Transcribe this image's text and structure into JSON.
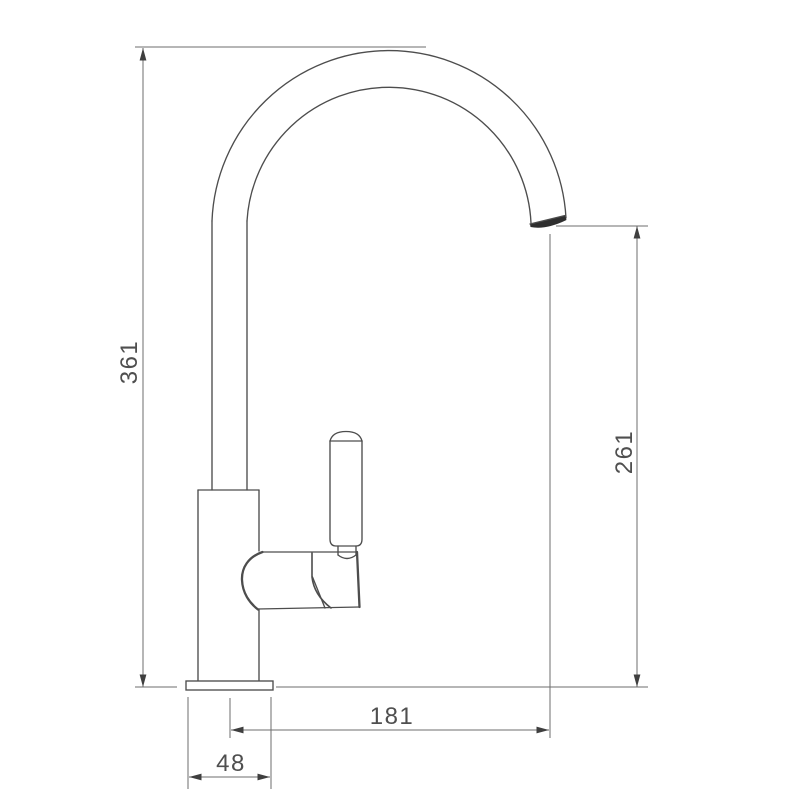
{
  "diagram": {
    "background_color": "#ffffff",
    "line_color": "#4d4d4d",
    "dim_line_color": "#6e6e6e",
    "label_color": "#4f4f4f",
    "labels": {
      "overall_height": "361",
      "outlet_height": "261",
      "spout_reach": "181",
      "base_width": "48"
    }
  }
}
